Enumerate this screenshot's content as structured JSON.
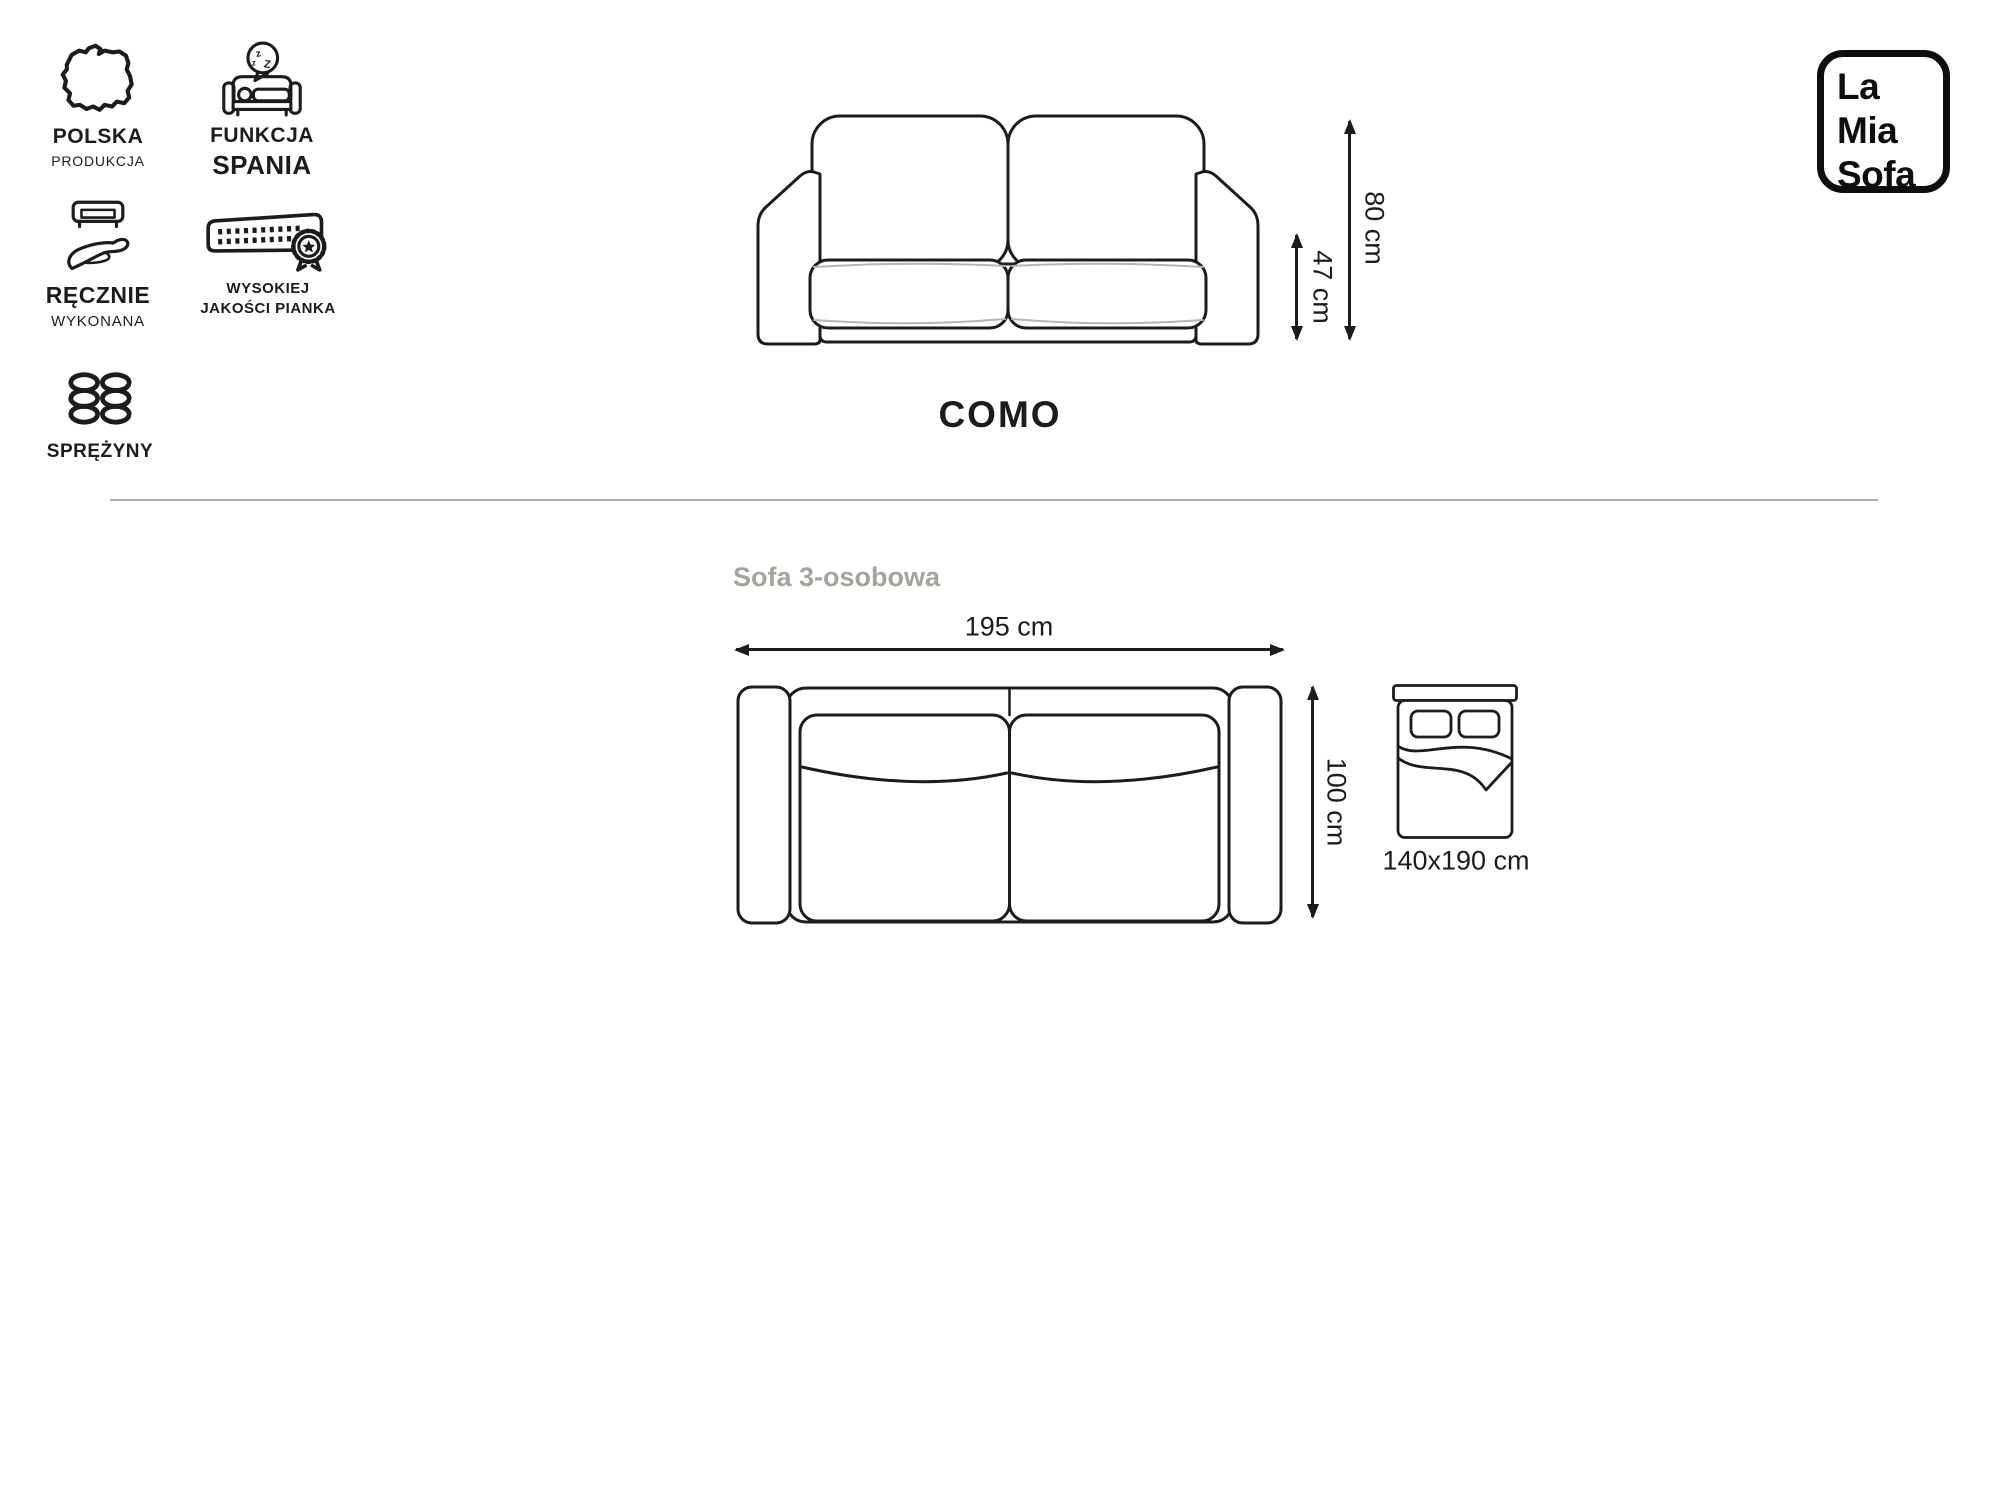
{
  "features": [
    {
      "line1": "POLSKA",
      "line2": "PRODUKCJA"
    },
    {
      "line1": "FUNKCJA",
      "line2": "SPANIA"
    },
    {
      "line1": "RĘCZNIE",
      "line2": "WYKONANA"
    },
    {
      "line1": "WYSOKIEJ",
      "line2": "JAKOŚCI PIANKA"
    },
    {
      "line1": "SPRĘŻYNY"
    }
  ],
  "product": {
    "name": "COMO",
    "variant": "Sofa 3-osobowa"
  },
  "dimensions": {
    "total_height": "80 cm",
    "seat_height": "47 cm",
    "width": "195 cm",
    "depth": "100 cm",
    "sleeping_area": "140x190 cm"
  },
  "logo": {
    "line1": "La",
    "line2": "Mia",
    "line3": "Sofa"
  },
  "colors": {
    "ink": "#1c1c1c",
    "muted_label": "#a3a59b",
    "divider": "#b0b0b0"
  }
}
